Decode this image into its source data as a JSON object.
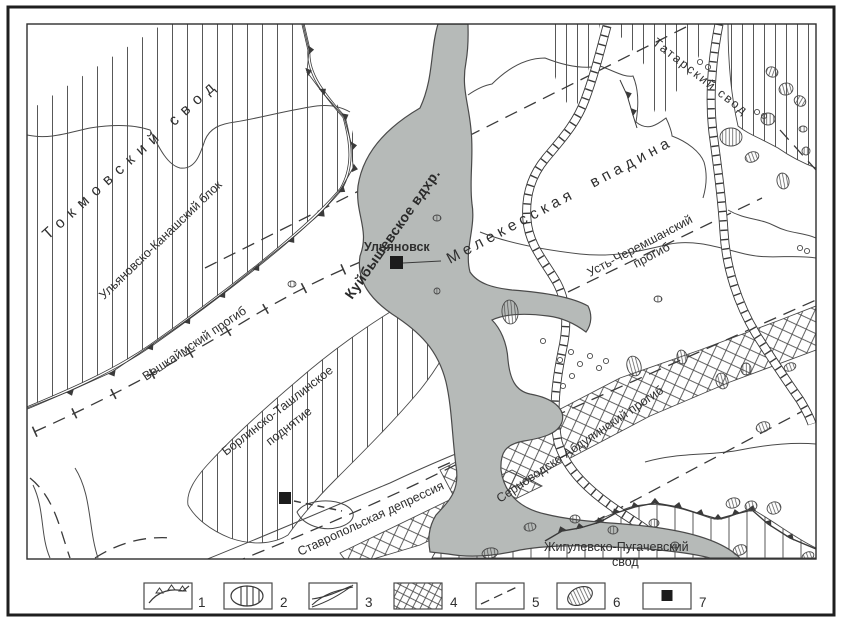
{
  "map": {
    "labels": {
      "tokmovsky_svod": "Токмовский свод",
      "ulyanovsko_kanashsky_blok": "Ульяновско-Канашский блок",
      "veshkaymsky_progib": "Вешкаймский прогиб",
      "kuybyshevskoe_vdkhr": "Куйбышевское вдхр.",
      "ulyanovsk_city": "Ульяновск",
      "melekesskaya_vpadina": "Мелекесская впадина",
      "tatarsky_svod": "Татарский свод",
      "ust_cheremshansky_line1": "Усть-Черемшанский",
      "ust_cheremshansky_line2": "прогиб",
      "borlinsko_tashlinskoe_line1": "Борлинско-Ташлинское",
      "borlinsko_tashlinskoe_line2": "поднятие",
      "stavropolskaya_depressiya": "Ставропольская депрессия",
      "sernovodsko_abdulinsky_progib": "Серноводско-Абдулинский прогиб",
      "zhigulevsko_pugachevsky_line1": "Жигулевско-Пугачевский",
      "zhigulevsko_pugachevsky_line2": "свод"
    },
    "colors": {
      "water": "#b6bab8",
      "line": "#3a3a3a",
      "frame": "#2e2e2e",
      "border": "#1f1f1f"
    }
  },
  "legend": {
    "items": [
      {
        "number": "1"
      },
      {
        "number": "2"
      },
      {
        "number": "3"
      },
      {
        "number": "4"
      },
      {
        "number": "5"
      },
      {
        "number": "6"
      },
      {
        "number": "7"
      }
    ]
  }
}
